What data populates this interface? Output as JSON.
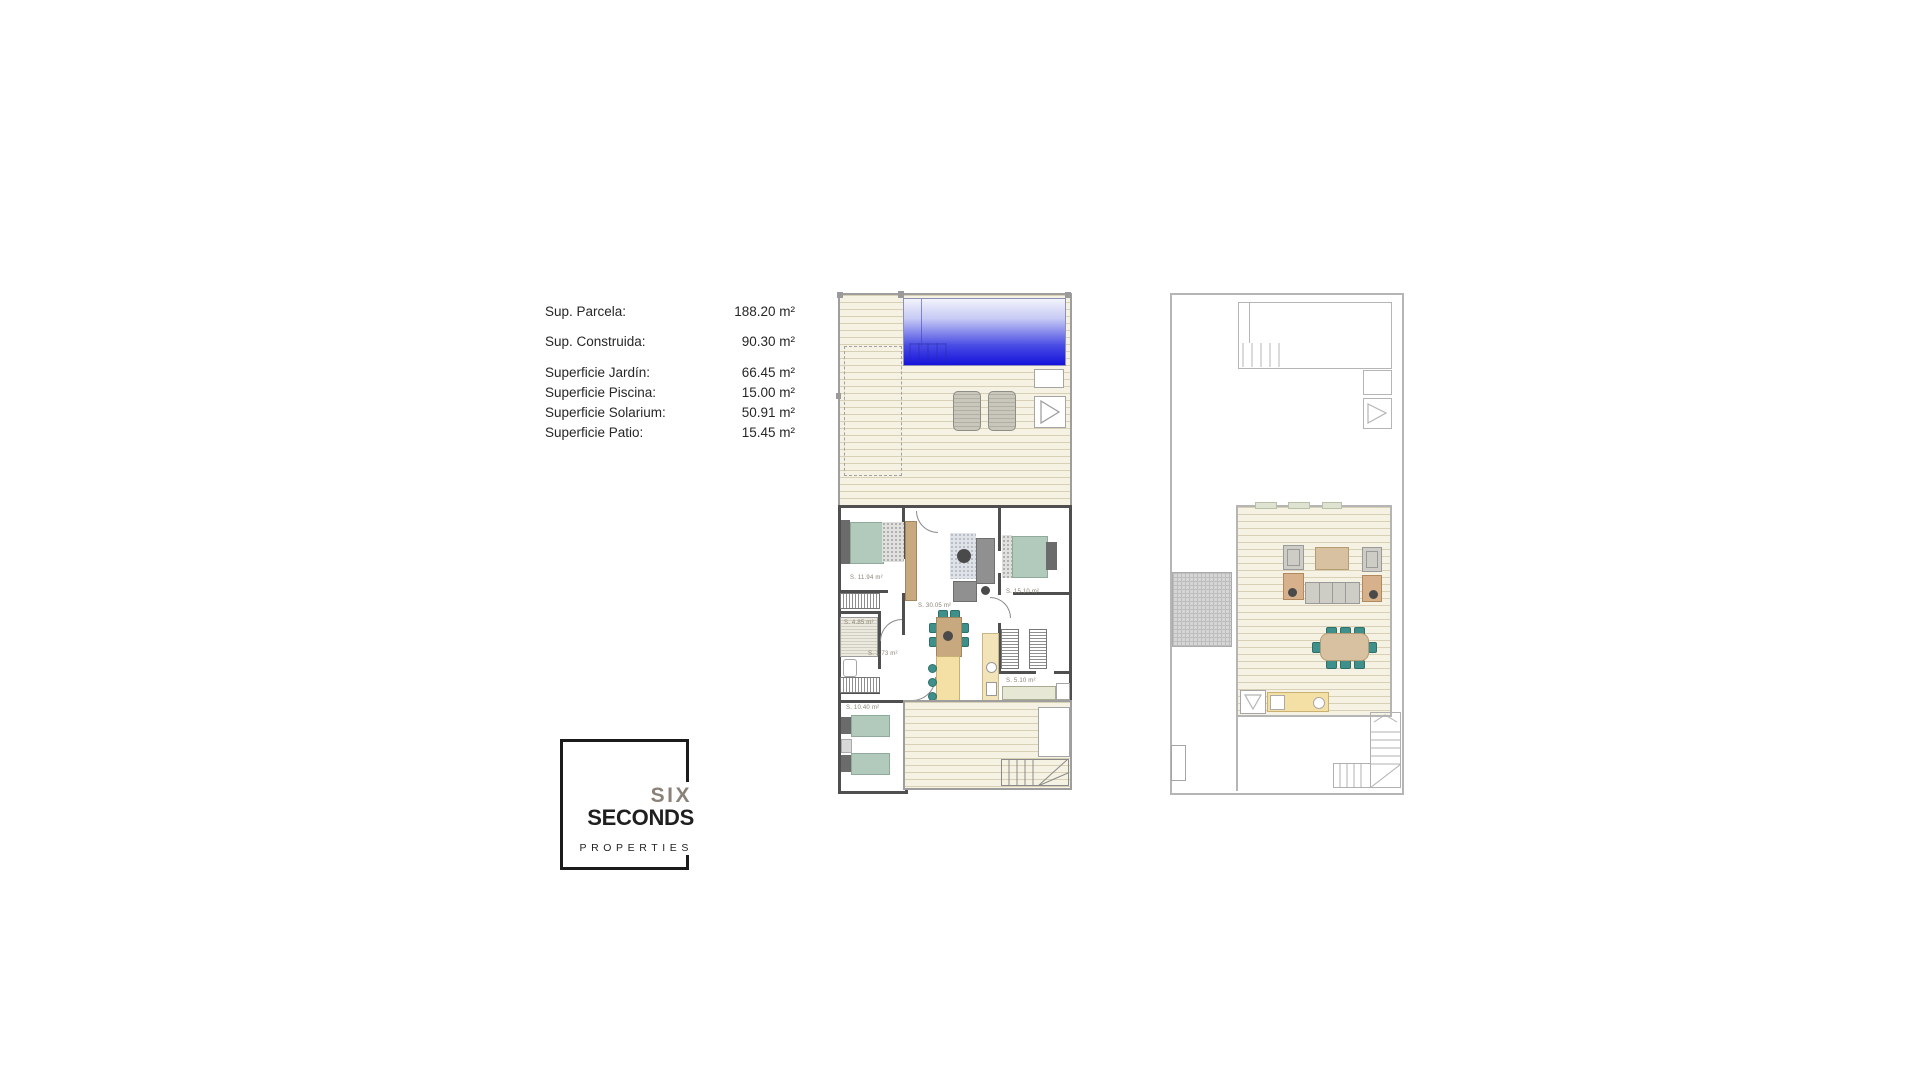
{
  "page": {
    "background": "#ffffff"
  },
  "summary": {
    "rows": [
      {
        "label": "Sup. Parcela:",
        "value": "188.20 m²"
      },
      {
        "label": "Sup. Construida:",
        "value": "90.30 m²"
      },
      {
        "label": "Superficie Jardín:",
        "value": "66.45 m²"
      },
      {
        "label": "Superficie Piscina:",
        "value": "15.00 m²"
      },
      {
        "label": "Superficie Solarium:",
        "value": "50.91 m²"
      },
      {
        "label": "Superficie Patio:",
        "value": "15.45 m²"
      }
    ]
  },
  "logo": {
    "line1": "SIX",
    "line2": "SECONDS",
    "line3": "PROPERTIES"
  },
  "plan1": {
    "title": "ground-floor-plan-with-garden-and-pool",
    "room_labels": [
      {
        "text": "S. 11.94 m²"
      },
      {
        "text": "S. 15.10 m²"
      },
      {
        "text": "S. 30.05 m²"
      },
      {
        "text": "S. 4.85 m²"
      },
      {
        "text": "S. 1.73 m²"
      },
      {
        "text": "S. 5.10 m²"
      },
      {
        "text": "S. 10.40 m²"
      }
    ]
  },
  "plan2": {
    "title": "solarium-roof-plan"
  },
  "colors": {
    "pool_top": "#f2f3fb",
    "pool_bottom": "#1512dc",
    "decking": "#f5f2e3",
    "wall_dark": "#4f4f4f",
    "wall_light": "#b5b5b5",
    "bed_sage": "#b2cabb",
    "chair_teal": "#3f8f8b",
    "wood_tan": "#c8a87e",
    "counter_yellow": "#f4e0a4",
    "logo_gray": "#8b8177",
    "logo_black": "#1b1b1b"
  }
}
